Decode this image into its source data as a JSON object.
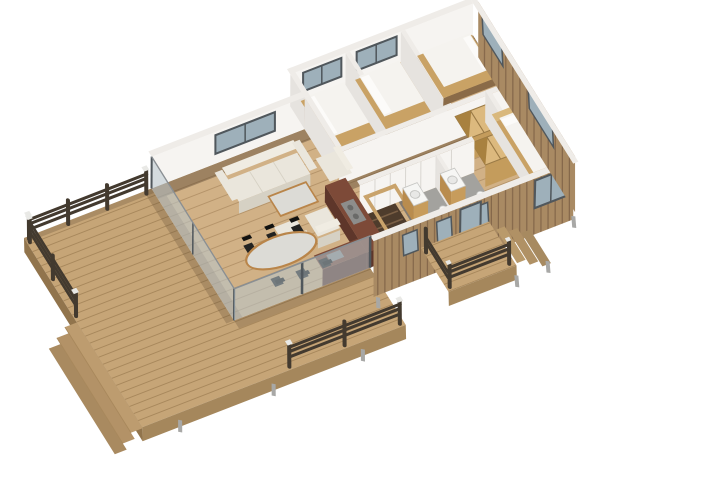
{
  "scene": {
    "type": "isometric-3d-floorplan-render",
    "background": "#ffffff",
    "areas": [
      {
        "name": "wood-deck-terrace",
        "features": [
          "plank-flooring",
          "dark-railings",
          "white-post-caps",
          "corner-steps"
        ]
      },
      {
        "name": "living-room",
        "features": [
          "cream-sofa",
          "three-armchairs",
          "marble-coffee-table",
          "glass-walls"
        ]
      },
      {
        "name": "dining-area",
        "features": [
          "oval-marble-table",
          "six-black-chairs"
        ]
      },
      {
        "name": "kitchen",
        "features": [
          "red-brown-counters",
          "gray-cooktop",
          "sink"
        ]
      },
      {
        "name": "hallway",
        "features": [
          "white-paneled-closet-doors",
          "floor-shadow"
        ]
      },
      {
        "name": "stairwell",
        "features": [
          "wood-walls",
          "dark-steps"
        ]
      },
      {
        "name": "bathroom-1",
        "features": [
          "gray-floor",
          "wood-vanity",
          "toilet"
        ]
      },
      {
        "name": "bathroom-2",
        "features": [
          "gray-floor",
          "wood-vanity",
          "toilet"
        ]
      },
      {
        "name": "bedroom-a",
        "features": [
          "white-bed",
          "wood-platform",
          "back-window"
        ]
      },
      {
        "name": "bedroom-b",
        "features": [
          "white-bed",
          "wood-platform",
          "back-window"
        ]
      },
      {
        "name": "bedroom-c-corner",
        "features": [
          "white-bed",
          "right-window"
        ]
      },
      {
        "name": "walk-in-closet",
        "features": [
          "plywood-open-wardrobes"
        ]
      },
      {
        "name": "right-bedroom",
        "features": [
          "white-bed",
          "wood-bench",
          "front-window"
        ]
      },
      {
        "name": "entry-porch",
        "features": [
          "dark-railing",
          "side-steps",
          "glass-door"
        ]
      },
      {
        "name": "exterior",
        "features": [
          "vertical-wood-siding",
          "blue-gray-windows",
          "support-posts"
        ]
      }
    ]
  },
  "palette": {
    "bg": "#ffffff",
    "deckWood": "#c6a577",
    "deckGap": "#a8885c",
    "deckEdge": "#a5875c",
    "deckEdgeDark": "#91744c",
    "floorWood": "#d1b186",
    "floorGap": "#b5946a",
    "bathFloor": "#a3a29e",
    "stairFloor": "#4e3c2c",
    "stairStep": "#7a5f45",
    "stairWall": "#c9a36b",
    "stairWallFace": "#a9855a",
    "wallLit": "#f6f4f1",
    "wallShade": "#e6e3df",
    "wallTop": "#efece8",
    "glass": "#b8c6ce",
    "glassSolid": "#9eb0ba",
    "glassFrame": "#50575c",
    "railDark": "#433a2f",
    "postCap": "#e9e9e6",
    "sofaCream": "#eae6dc",
    "sofaHi": "#f0ece2",
    "sofaShade": "#d6d1c4",
    "marble": "#dcdbd6",
    "woodTrim": "#b9854a",
    "chairBlack": "#232321",
    "chairBackBlack": "#121210",
    "bedPlatform": "#c9a265",
    "bedPlatformDark": "#8a6b48",
    "mattress": "#f5f3ef",
    "pillow": "#fcfbf9",
    "plywood": "#dcb97e",
    "plywoodLine": "#9a7a46",
    "plywoodFace": "#c49c5c",
    "plywoodDark": "#a8813f",
    "counterRed": "#7d4a38",
    "counterRedDark": "#5e362a",
    "cooktopGray": "#8d8d8b",
    "burnerGray": "#6a6a68",
    "fixtureWhite": "#f6f6f4",
    "fixtureLine": "#c5c5c2",
    "vanityWood": "#c79c5c",
    "vanitySide": "#b98c4e",
    "siding": "#a98a63",
    "sidingGap": "#84674a",
    "shadowBrown": "#4a3726",
    "supportGray": "#a8a8a6",
    "doorSeam": "#d9d6d1",
    "benchWood": "#d9b87c"
  }
}
